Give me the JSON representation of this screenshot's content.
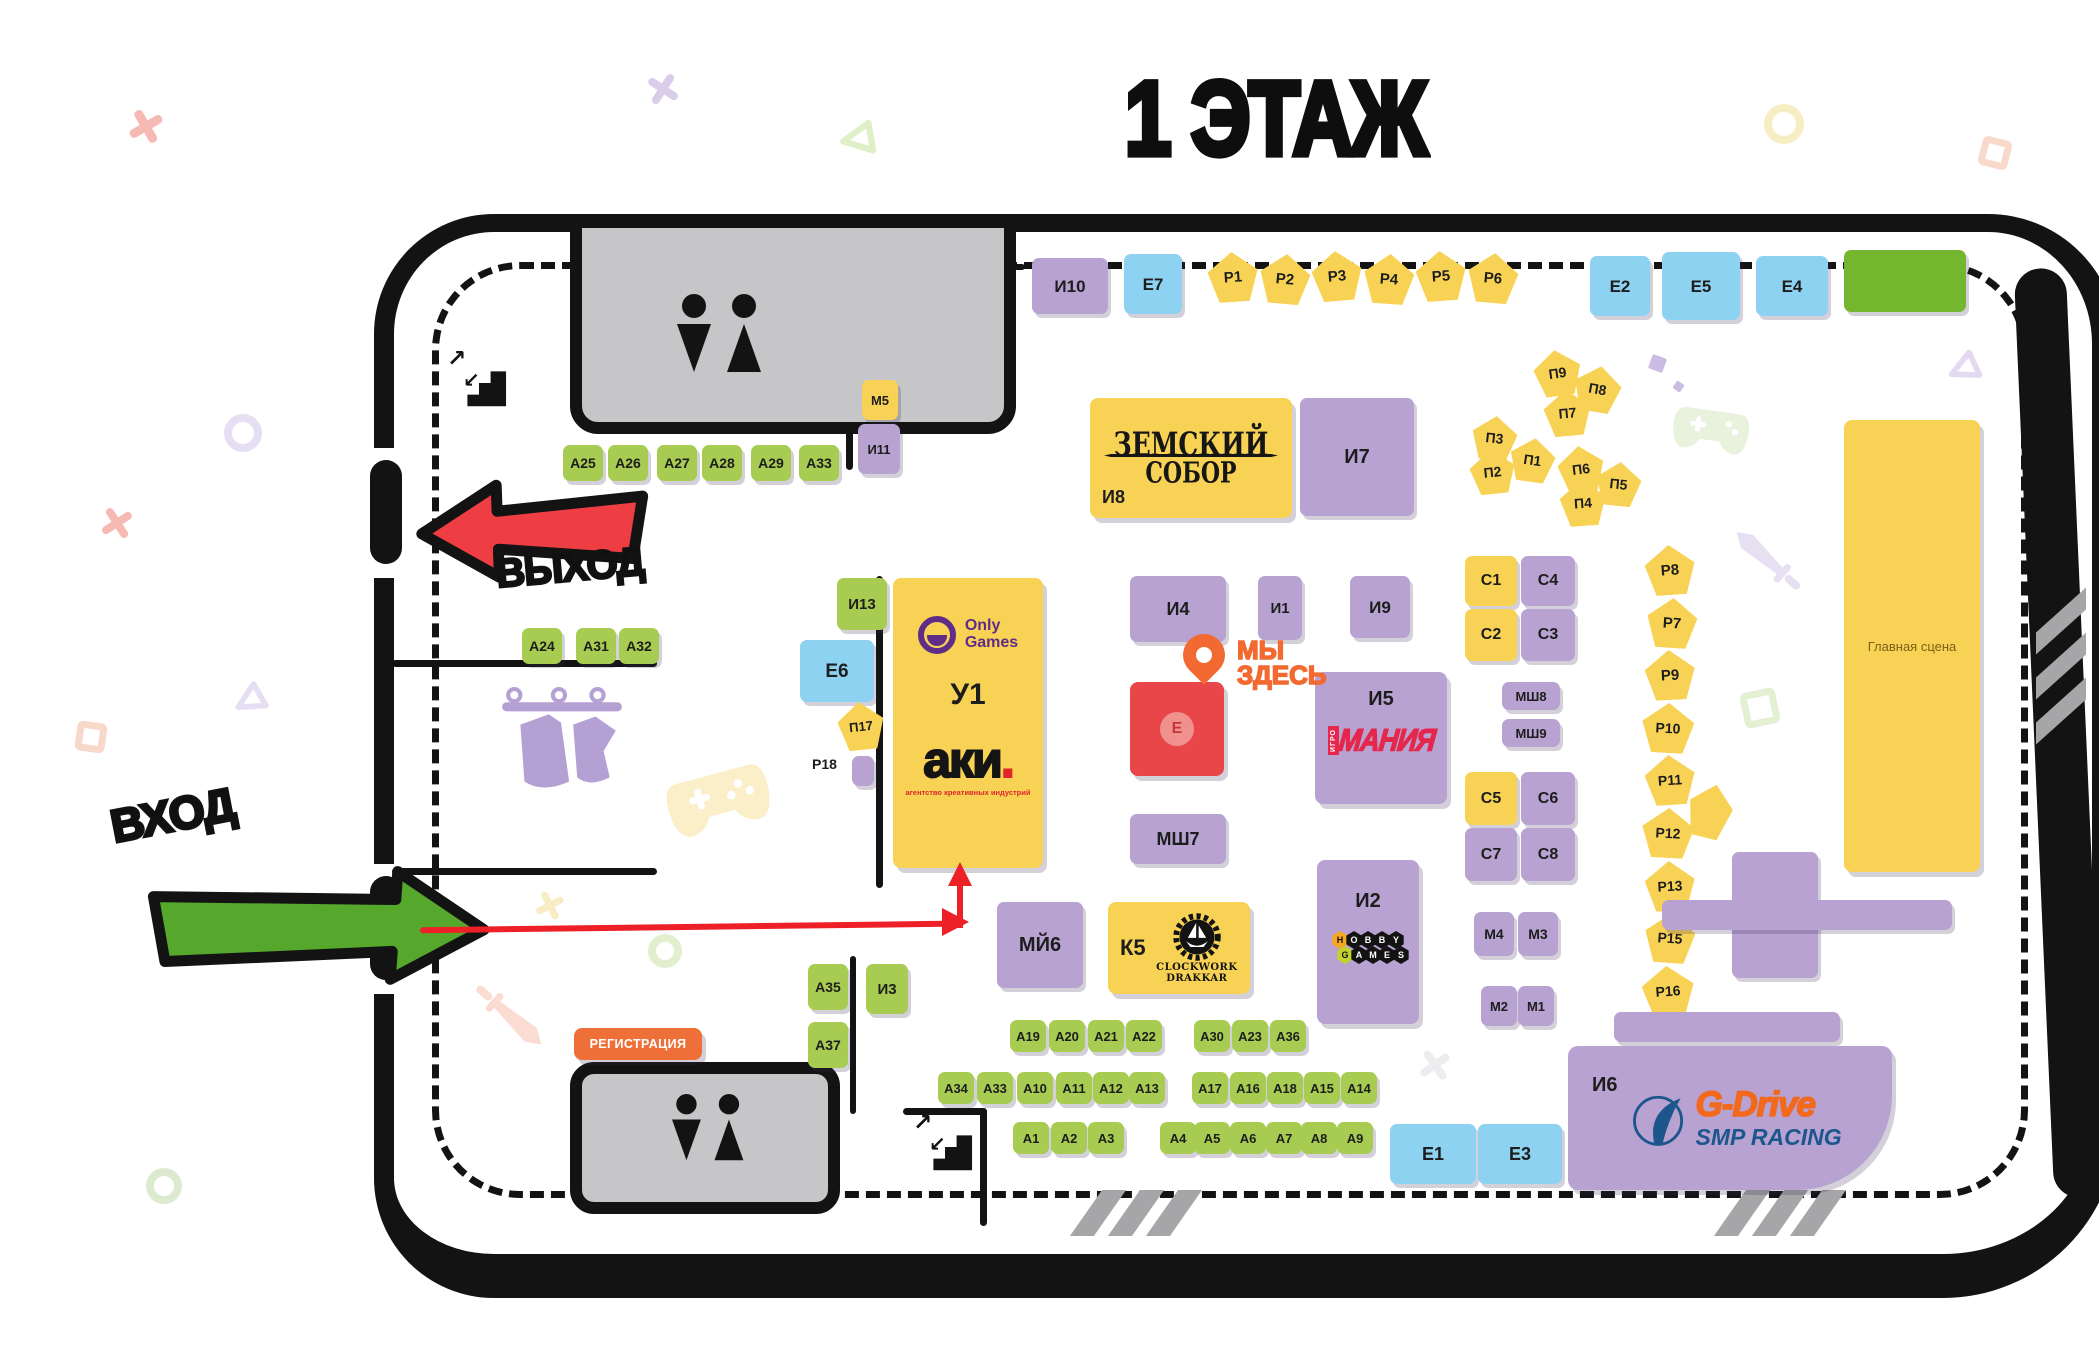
{
  "title": "1 ЭТАЖ",
  "colors": {
    "purple": "#b7a2d1",
    "green": "#a7cc51",
    "blue": "#8ed2f2",
    "yellow": "#f8d255",
    "biggreen": "#74b72e",
    "red": "#e9464a",
    "orange": "#ee7038",
    "path": "#ed2027",
    "pin": "#f26a31",
    "exitArrow": "#ee3d43",
    "entranceArrow": "#55a82b"
  },
  "map": {
    "exit_label": "ВЫХОД",
    "entrance_label": "ВХОД",
    "registration_label": "РЕГИСТРАЦИЯ",
    "here_line1": "МЫ",
    "here_line2": "ЗДЕСЬ",
    "main_stage_label": "Главная сцена"
  },
  "special_booths": {
    "u1": {
      "id": "У1",
      "logo_line1": "Only",
      "logo_line2": "Games",
      "brand": "аки",
      "brand_dot": ".",
      "brand_sub": "агентство креативных индустрий"
    },
    "i8": {
      "id": "И8",
      "line1": "ЗЕМСКИЙ",
      "line2": "СОБОР"
    },
    "i5": {
      "id": "И5",
      "vertical": "ИГРО",
      "main": "МАНИЯ"
    },
    "i2": {
      "id": "И2",
      "row1": [
        "H",
        "O",
        "B",
        "B",
        "Y"
      ],
      "row2": [
        "G",
        "A",
        "M",
        "E",
        "S"
      ]
    },
    "k5": {
      "id": "К5",
      "line1": "CLOCKWORK",
      "line2": "DRAKKAR"
    },
    "i6": {
      "id": "И6",
      "brand": "G-Drive",
      "sub": "SMP RACING"
    },
    "e_red": {
      "id": "Е"
    }
  },
  "free_labels": [
    {
      "text": "Р18",
      "x": 812,
      "y": 756,
      "fs": 14
    }
  ],
  "booths": [
    {
      "id": "i10",
      "label": "И10",
      "t": "purple",
      "x": 1032,
      "y": 258,
      "w": 76,
      "h": 56,
      "fs": 17
    },
    {
      "id": "e7",
      "label": "Е7",
      "t": "blue",
      "x": 1124,
      "y": 254,
      "w": 58,
      "h": 60,
      "fs": 17
    },
    {
      "id": "r1",
      "label": "Р1",
      "t": "pent",
      "x": 1208,
      "y": 252,
      "w": 50,
      "h": 50,
      "r": -4,
      "fs": 15
    },
    {
      "id": "r2",
      "label": "Р2",
      "t": "pent",
      "x": 1260,
      "y": 254,
      "w": 50,
      "h": 50,
      "r": 5,
      "fs": 15
    },
    {
      "id": "r3",
      "label": "Р3",
      "t": "pent",
      "x": 1312,
      "y": 251,
      "w": 50,
      "h": 50,
      "r": -5,
      "fs": 15
    },
    {
      "id": "r4",
      "label": "Р4",
      "t": "pent",
      "x": 1364,
      "y": 254,
      "w": 50,
      "h": 50,
      "r": 4,
      "fs": 15
    },
    {
      "id": "r5",
      "label": "Р5",
      "t": "pent",
      "x": 1416,
      "y": 251,
      "w": 50,
      "h": 50,
      "r": -4,
      "fs": 15
    },
    {
      "id": "r6",
      "label": "Р6",
      "t": "pent",
      "x": 1468,
      "y": 253,
      "w": 50,
      "h": 50,
      "r": 5,
      "fs": 15
    },
    {
      "id": "e2",
      "label": "Е2",
      "t": "blue",
      "x": 1590,
      "y": 256,
      "w": 60,
      "h": 60,
      "fs": 17
    },
    {
      "id": "e5",
      "label": "Е5",
      "t": "blue",
      "x": 1662,
      "y": 252,
      "w": 78,
      "h": 68,
      "fs": 17
    },
    {
      "id": "e4",
      "label": "Е4",
      "t": "blue",
      "x": 1756,
      "y": 256,
      "w": 72,
      "h": 60,
      "fs": 17
    },
    {
      "id": "green-block",
      "label": "",
      "t": "biggreen",
      "x": 1844,
      "y": 250,
      "w": 122,
      "h": 62
    },
    {
      "id": "m5",
      "label": "М5",
      "t": "yellow",
      "x": 862,
      "y": 380,
      "w": 36,
      "h": 40,
      "fs": 13
    },
    {
      "id": "i11",
      "label": "И11",
      "t": "purple",
      "x": 858,
      "y": 424,
      "w": 42,
      "h": 50,
      "fs": 13
    },
    {
      "id": "a25",
      "label": "А25",
      "t": "green",
      "x": 563,
      "y": 445,
      "w": 40,
      "h": 36,
      "fs": 14
    },
    {
      "id": "a26",
      "label": "А26",
      "t": "green",
      "x": 608,
      "y": 445,
      "w": 40,
      "h": 36,
      "fs": 14
    },
    {
      "id": "a27",
      "label": "А27",
      "t": "green",
      "x": 657,
      "y": 445,
      "w": 40,
      "h": 36,
      "fs": 14
    },
    {
      "id": "a28",
      "label": "А28",
      "t": "green",
      "x": 702,
      "y": 445,
      "w": 40,
      "h": 36,
      "fs": 14
    },
    {
      "id": "a29",
      "label": "А29",
      "t": "green",
      "x": 751,
      "y": 445,
      "w": 40,
      "h": 36,
      "fs": 14
    },
    {
      "id": "a33t",
      "label": "А33",
      "t": "green",
      "x": 799,
      "y": 445,
      "w": 40,
      "h": 36,
      "fs": 14
    },
    {
      "id": "i8b",
      "label": "",
      "t": "none",
      "x": 0,
      "y": 0,
      "w": 0,
      "h": 0
    },
    {
      "id": "i7",
      "label": "И7",
      "t": "purple",
      "x": 1300,
      "y": 398,
      "w": 114,
      "h": 118,
      "fs": 20
    },
    {
      "id": "p9",
      "label": "П9",
      "t": "pent",
      "x": 1534,
      "y": 350,
      "w": 47,
      "h": 46,
      "r": -8,
      "fs": 14
    },
    {
      "id": "p8",
      "label": "П8",
      "t": "pent",
      "x": 1574,
      "y": 366,
      "w": 47,
      "h": 46,
      "r": 10,
      "fs": 14
    },
    {
      "id": "p7",
      "label": "П7",
      "t": "pent",
      "x": 1544,
      "y": 390,
      "w": 47,
      "h": 46,
      "r": -5,
      "fs": 14
    },
    {
      "id": "p3",
      "label": "П3",
      "t": "pent",
      "x": 1472,
      "y": 416,
      "w": 45,
      "h": 44,
      "r": 6,
      "fs": 14
    },
    {
      "id": "p2",
      "label": "П2",
      "t": "pent",
      "x": 1470,
      "y": 450,
      "w": 45,
      "h": 44,
      "r": -6,
      "fs": 14
    },
    {
      "id": "p1",
      "label": "П1",
      "t": "pent",
      "x": 1510,
      "y": 438,
      "w": 45,
      "h": 44,
      "r": 8,
      "fs": 14
    },
    {
      "id": "p6",
      "label": "П6",
      "t": "pent",
      "x": 1558,
      "y": 446,
      "w": 46,
      "h": 46,
      "r": -7,
      "fs": 14
    },
    {
      "id": "p5",
      "label": "П5",
      "t": "pent",
      "x": 1596,
      "y": 462,
      "w": 45,
      "h": 44,
      "r": 6,
      "fs": 14
    },
    {
      "id": "p4",
      "label": "П4",
      "t": "pent",
      "x": 1560,
      "y": 480,
      "w": 46,
      "h": 46,
      "r": -4,
      "fs": 14
    },
    {
      "id": "a24",
      "label": "А24",
      "t": "green",
      "x": 522,
      "y": 628,
      "w": 40,
      "h": 36,
      "fs": 14
    },
    {
      "id": "a31",
      "label": "А31",
      "t": "green",
      "x": 576,
      "y": 628,
      "w": 40,
      "h": 36,
      "fs": 14
    },
    {
      "id": "a32",
      "label": "А32",
      "t": "green",
      "x": 619,
      "y": 628,
      "w": 40,
      "h": 36,
      "fs": 14
    },
    {
      "id": "i13",
      "label": "И13",
      "t": "green",
      "x": 837,
      "y": 578,
      "w": 50,
      "h": 52,
      "fs": 15
    },
    {
      "id": "e6",
      "label": "Е6",
      "t": "blue",
      "x": 800,
      "y": 640,
      "w": 74,
      "h": 62,
      "fs": 19
    },
    {
      "id": "p17",
      "label": "П17",
      "t": "pent",
      "x": 838,
      "y": 702,
      "w": 46,
      "h": 48,
      "r": -6,
      "fs": 13
    },
    {
      "id": "r18b",
      "label": "",
      "t": "purple",
      "x": 852,
      "y": 756,
      "w": 22,
      "h": 30
    },
    {
      "id": "i4",
      "label": "И4",
      "t": "purple",
      "x": 1130,
      "y": 576,
      "w": 96,
      "h": 66,
      "fs": 18
    },
    {
      "id": "i1",
      "label": "И1",
      "t": "purple",
      "x": 1258,
      "y": 576,
      "w": 44,
      "h": 64,
      "fs": 15
    },
    {
      "id": "i9",
      "label": "И9",
      "t": "purple",
      "x": 1350,
      "y": 576,
      "w": 60,
      "h": 62,
      "fs": 17
    },
    {
      "id": "c1",
      "label": "С1",
      "t": "yellow",
      "x": 1465,
      "y": 556,
      "w": 52,
      "h": 50,
      "fs": 16
    },
    {
      "id": "c4",
      "label": "С4",
      "t": "purple",
      "x": 1521,
      "y": 556,
      "w": 54,
      "h": 50,
      "fs": 16
    },
    {
      "id": "c2",
      "label": "С2",
      "t": "yellow",
      "x": 1465,
      "y": 609,
      "w": 52,
      "h": 52,
      "fs": 16
    },
    {
      "id": "c3",
      "label": "С3",
      "t": "purple",
      "x": 1521,
      "y": 609,
      "w": 54,
      "h": 52,
      "fs": 16
    },
    {
      "id": "msh8",
      "label": "МШ8",
      "t": "purple",
      "x": 1502,
      "y": 682,
      "w": 58,
      "h": 28,
      "fs": 13
    },
    {
      "id": "msh9",
      "label": "МШ9",
      "t": "purple",
      "x": 1502,
      "y": 719,
      "w": 58,
      "h": 28,
      "fs": 13
    },
    {
      "id": "c5",
      "label": "С5",
      "t": "yellow",
      "x": 1465,
      "y": 772,
      "w": 52,
      "h": 53,
      "fs": 16
    },
    {
      "id": "c6",
      "label": "С6",
      "t": "purple",
      "x": 1521,
      "y": 772,
      "w": 54,
      "h": 53,
      "fs": 16
    },
    {
      "id": "c7",
      "label": "С7",
      "t": "purple",
      "x": 1465,
      "y": 828,
      "w": 52,
      "h": 53,
      "fs": 16
    },
    {
      "id": "c8",
      "label": "С8",
      "t": "purple",
      "x": 1521,
      "y": 828,
      "w": 54,
      "h": 53,
      "fs": 16
    },
    {
      "id": "m4",
      "label": "М4",
      "t": "purple",
      "x": 1474,
      "y": 912,
      "w": 40,
      "h": 44,
      "fs": 14
    },
    {
      "id": "m3",
      "label": "М3",
      "t": "purple",
      "x": 1518,
      "y": 912,
      "w": 40,
      "h": 44,
      "fs": 14
    },
    {
      "id": "m2",
      "label": "М2",
      "t": "purple",
      "x": 1481,
      "y": 986,
      "w": 36,
      "h": 40,
      "fs": 13
    },
    {
      "id": "m1",
      "label": "М1",
      "t": "purple",
      "x": 1518,
      "y": 986,
      "w": 36,
      "h": 40,
      "fs": 13
    },
    {
      "id": "rc8",
      "label": "Р8",
      "t": "pent",
      "x": 1645,
      "y": 545,
      "w": 50,
      "h": 50,
      "r": -4,
      "fs": 15
    },
    {
      "id": "rc7",
      "label": "Р7",
      "t": "pent",
      "x": 1647,
      "y": 598,
      "w": 50,
      "h": 50,
      "r": 4,
      "fs": 15
    },
    {
      "id": "rc9",
      "label": "Р9",
      "t": "pent",
      "x": 1645,
      "y": 650,
      "w": 50,
      "h": 50,
      "r": -3,
      "fs": 15
    },
    {
      "id": "rc10",
      "label": "Р10",
      "t": "pent",
      "x": 1642,
      "y": 703,
      "w": 52,
      "h": 50,
      "r": 3,
      "fs": 14
    },
    {
      "id": "rc11",
      "label": "Р11",
      "t": "pent",
      "x": 1645,
      "y": 755,
      "w": 50,
      "h": 50,
      "r": -4,
      "fs": 14
    },
    {
      "id": "rc12",
      "label": "Р12",
      "t": "pent",
      "x": 1642,
      "y": 808,
      "w": 52,
      "h": 50,
      "r": 3,
      "fs": 14
    },
    {
      "id": "rc13",
      "label": "Р13",
      "t": "pent",
      "x": 1645,
      "y": 861,
      "w": 50,
      "h": 50,
      "r": -3,
      "fs": 14
    },
    {
      "id": "rc15",
      "label": "Р15",
      "t": "pent",
      "x": 1645,
      "y": 913,
      "w": 50,
      "h": 50,
      "r": 4,
      "fs": 14
    },
    {
      "id": "rc16",
      "label": "Р16",
      "t": "pent",
      "x": 1642,
      "y": 966,
      "w": 52,
      "h": 50,
      "r": -4,
      "fs": 14
    },
    {
      "id": "pent-unlabeled",
      "label": "",
      "t": "pent",
      "x": 1688,
      "y": 784,
      "w": 44,
      "h": 54,
      "r": 14
    },
    {
      "id": "msh12",
      "label": "МШ12",
      "t": "purple",
      "x": 1732,
      "y": 852,
      "w": 86,
      "h": 126,
      "fs": 16
    },
    {
      "id": "msh7",
      "label": "МШ7",
      "t": "purple",
      "x": 1130,
      "y": 814,
      "w": 96,
      "h": 50,
      "fs": 18
    },
    {
      "id": "mii6",
      "label": "МЙ6",
      "t": "purple",
      "x": 997,
      "y": 902,
      "w": 86,
      "h": 86,
      "fs": 20
    },
    {
      "id": "a35",
      "label": "А35",
      "t": "green",
      "x": 808,
      "y": 964,
      "w": 40,
      "h": 46,
      "fs": 14
    },
    {
      "id": "a37",
      "label": "А37",
      "t": "green",
      "x": 808,
      "y": 1022,
      "w": 40,
      "h": 46,
      "fs": 14
    },
    {
      "id": "i3",
      "label": "И3",
      "t": "green",
      "x": 866,
      "y": 964,
      "w": 42,
      "h": 50,
      "fs": 15
    },
    {
      "id": "a19",
      "label": "А19",
      "t": "green",
      "x": 1010,
      "y": 1020,
      "w": 36,
      "h": 32,
      "fs": 13
    },
    {
      "id": "a20",
      "label": "А20",
      "t": "green",
      "x": 1049,
      "y": 1020,
      "w": 36,
      "h": 32,
      "fs": 13
    },
    {
      "id": "a21",
      "label": "А21",
      "t": "green",
      "x": 1088,
      "y": 1020,
      "w": 36,
      "h": 32,
      "fs": 13
    },
    {
      "id": "a22",
      "label": "А22",
      "t": "green",
      "x": 1126,
      "y": 1020,
      "w": 36,
      "h": 32,
      "fs": 13
    },
    {
      "id": "a30",
      "label": "А30",
      "t": "green",
      "x": 1194,
      "y": 1020,
      "w": 36,
      "h": 32,
      "fs": 13
    },
    {
      "id": "a23",
      "label": "А23",
      "t": "green",
      "x": 1232,
      "y": 1020,
      "w": 36,
      "h": 32,
      "fs": 13
    },
    {
      "id": "a36",
      "label": "А36",
      "t": "green",
      "x": 1270,
      "y": 1020,
      "w": 36,
      "h": 32,
      "fs": 13
    },
    {
      "id": "a34",
      "label": "А34",
      "t": "green",
      "x": 938,
      "y": 1072,
      "w": 36,
      "h": 32,
      "fs": 13
    },
    {
      "id": "a33b",
      "label": "А33",
      "t": "green",
      "x": 977,
      "y": 1072,
      "w": 36,
      "h": 32,
      "fs": 13
    },
    {
      "id": "a10",
      "label": "А10",
      "t": "green",
      "x": 1017,
      "y": 1072,
      "w": 36,
      "h": 32,
      "fs": 13
    },
    {
      "id": "a11",
      "label": "А11",
      "t": "green",
      "x": 1056,
      "y": 1072,
      "w": 36,
      "h": 32,
      "fs": 13
    },
    {
      "id": "a12",
      "label": "А12",
      "t": "green",
      "x": 1093,
      "y": 1072,
      "w": 36,
      "h": 32,
      "fs": 13
    },
    {
      "id": "a13",
      "label": "А13",
      "t": "green",
      "x": 1129,
      "y": 1072,
      "w": 36,
      "h": 32,
      "fs": 13
    },
    {
      "id": "a17",
      "label": "А17",
      "t": "green",
      "x": 1192,
      "y": 1072,
      "w": 36,
      "h": 32,
      "fs": 13
    },
    {
      "id": "a16",
      "label": "А16",
      "t": "green",
      "x": 1230,
      "y": 1072,
      "w": 36,
      "h": 32,
      "fs": 13
    },
    {
      "id": "a18",
      "label": "А18",
      "t": "green",
      "x": 1267,
      "y": 1072,
      "w": 36,
      "h": 32,
      "fs": 13
    },
    {
      "id": "a15",
      "label": "А15",
      "t": "green",
      "x": 1304,
      "y": 1072,
      "w": 36,
      "h": 32,
      "fs": 13
    },
    {
      "id": "a14",
      "label": "А14",
      "t": "green",
      "x": 1341,
      "y": 1072,
      "w": 36,
      "h": 32,
      "fs": 13
    },
    {
      "id": "a1",
      "label": "А1",
      "t": "green",
      "x": 1013,
      "y": 1122,
      "w": 36,
      "h": 32,
      "fs": 13
    },
    {
      "id": "a2",
      "label": "А2",
      "t": "green",
      "x": 1051,
      "y": 1122,
      "w": 36,
      "h": 32,
      "fs": 13
    },
    {
      "id": "a3",
      "label": "А3",
      "t": "green",
      "x": 1088,
      "y": 1122,
      "w": 36,
      "h": 32,
      "fs": 13
    },
    {
      "id": "a4",
      "label": "А4",
      "t": "green",
      "x": 1160,
      "y": 1122,
      "w": 36,
      "h": 32,
      "fs": 13
    },
    {
      "id": "a5",
      "label": "А5",
      "t": "green",
      "x": 1194,
      "y": 1122,
      "w": 36,
      "h": 32,
      "fs": 13
    },
    {
      "id": "a6",
      "label": "А6",
      "t": "green",
      "x": 1230,
      "y": 1122,
      "w": 36,
      "h": 32,
      "fs": 13
    },
    {
      "id": "a7",
      "label": "А7",
      "t": "green",
      "x": 1266,
      "y": 1122,
      "w": 36,
      "h": 32,
      "fs": 13
    },
    {
      "id": "a8",
      "label": "А8",
      "t": "green",
      "x": 1301,
      "y": 1122,
      "w": 36,
      "h": 32,
      "fs": 13
    },
    {
      "id": "a9",
      "label": "А9",
      "t": "green",
      "x": 1337,
      "y": 1122,
      "w": 36,
      "h": 32,
      "fs": 13
    },
    {
      "id": "e1",
      "label": "Е1",
      "t": "blue",
      "x": 1390,
      "y": 1124,
      "w": 86,
      "h": 60,
      "fs": 18
    },
    {
      "id": "e3",
      "label": "Е3",
      "t": "blue",
      "x": 1478,
      "y": 1124,
      "w": 84,
      "h": 60,
      "fs": 18
    },
    {
      "id": "bar1",
      "label": "",
      "t": "purple",
      "x": 1662,
      "y": 900,
      "w": 290,
      "h": 30
    },
    {
      "id": "bar2",
      "label": "",
      "t": "purple",
      "x": 1614,
      "y": 1012,
      "w": 226,
      "h": 30
    }
  ],
  "decor": [
    {
      "t": "x",
      "x": 128,
      "y": 108,
      "s": 36,
      "c": "#f6b9b4",
      "r": 15
    },
    {
      "t": "x",
      "x": 646,
      "y": 72,
      "s": 34,
      "c": "#d9cdea",
      "r": -12
    },
    {
      "t": "tri",
      "x": 838,
      "y": 120,
      "s": 38,
      "c": "#dff0c8",
      "r": -10
    },
    {
      "t": "ring",
      "x": 1764,
      "y": 104,
      "s": 40,
      "c": "#f7edc3"
    },
    {
      "t": "sq",
      "x": 1980,
      "y": 138,
      "s": 30,
      "c": "#f9d9cb",
      "r": 14
    },
    {
      "t": "tri",
      "x": 1946,
      "y": 352,
      "s": 34,
      "c": "#e3d9f1",
      "r": -25
    },
    {
      "t": "x",
      "x": 100,
      "y": 506,
      "s": 34,
      "c": "#f6b9b4",
      "r": 12
    },
    {
      "t": "ring",
      "x": 224,
      "y": 414,
      "s": 38,
      "c": "#e6def2"
    },
    {
      "t": "tri",
      "x": 232,
      "y": 684,
      "s": 34,
      "c": "#e6def2",
      "r": -30
    },
    {
      "t": "sq",
      "x": 76,
      "y": 722,
      "s": 30,
      "c": "#f8d8ca",
      "r": 8
    },
    {
      "t": "ring",
      "x": 146,
      "y": 1168,
      "s": 36,
      "c": "#dcead0"
    },
    {
      "t": "x",
      "x": 535,
      "y": 890,
      "s": 30,
      "c": "#f8ecc4",
      "r": 18
    },
    {
      "t": "ring",
      "x": 648,
      "y": 934,
      "s": 34,
      "c": "#e2efcf"
    },
    {
      "t": "sq",
      "x": 1742,
      "y": 690,
      "s": 36,
      "c": "#e4f0d4",
      "r": -12
    },
    {
      "t": "spark",
      "x": 1650,
      "y": 356,
      "s": 15,
      "c": "#cabce2",
      "r": 20
    },
    {
      "t": "spark",
      "x": 1674,
      "y": 382,
      "s": 9,
      "c": "#cabce2",
      "r": 35
    },
    {
      "t": "x",
      "x": 1418,
      "y": 1048,
      "s": 34,
      "c": "#ededef",
      "r": 10
    }
  ]
}
